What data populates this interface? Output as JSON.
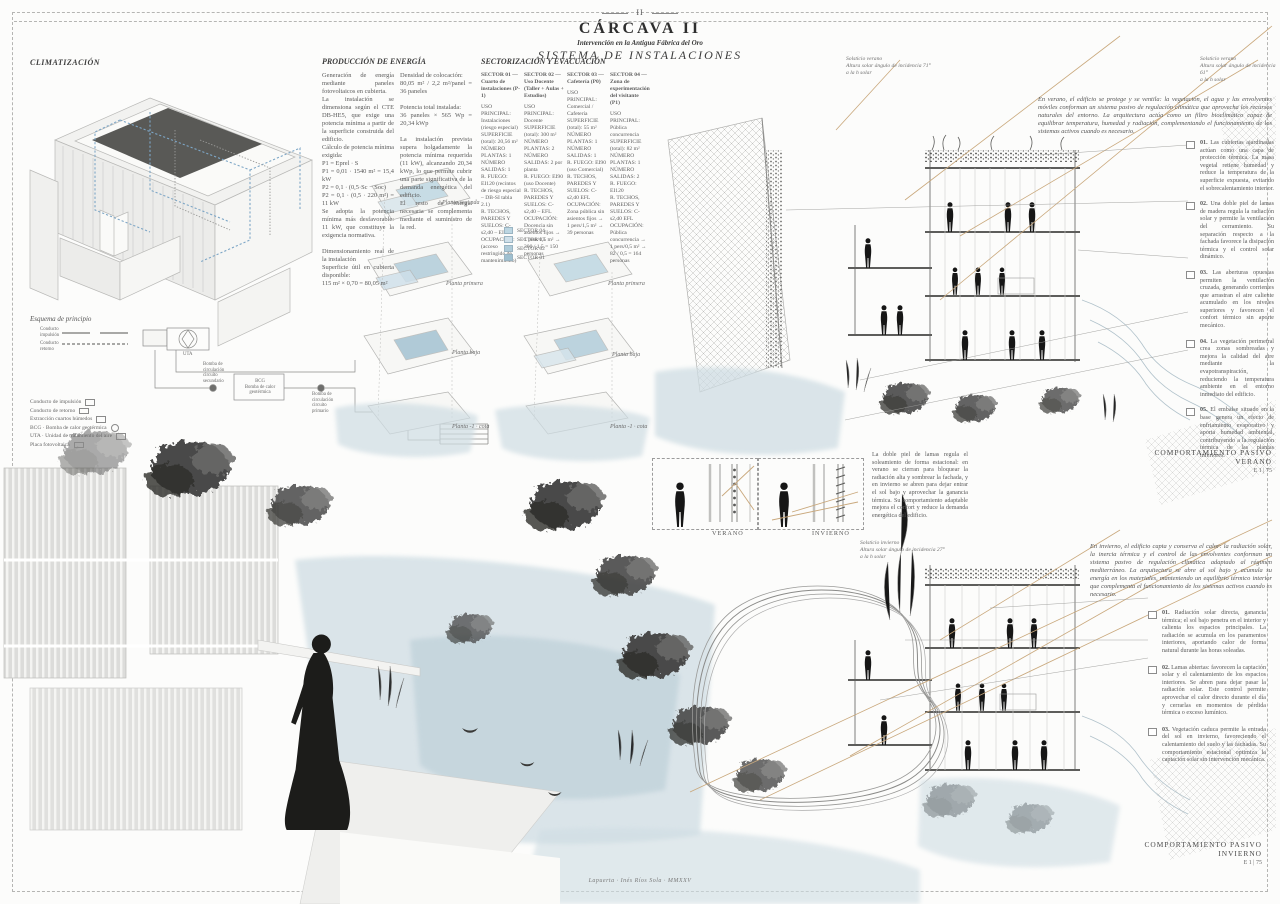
{
  "title_block": {
    "page_num": "II",
    "title": "CÁRCAVA II",
    "subtitle": "Intervención en la Antigua Fábrica del Oro",
    "section": "SISTEMA DE INSTALACIONES"
  },
  "colors": {
    "paper": "#fcfcfb",
    "ink": "#4c4c4c",
    "drawing_gray": "#c9c9c9",
    "duct_blue": "#7da6c6",
    "wash_blue": "#cfdde3",
    "sun_tan": "#c9a87c",
    "sector_fill": "#bcd6e2"
  },
  "climatizacion": {
    "heading": "CLIMATIZACIÓN",
    "esquema_label": "Esquema de principio",
    "schematic": {
      "uta": "UTA",
      "bcg": "BCG\nBomba de calor\ngeotérmica",
      "bomba_secundario": "Bomba de\ncirculación\ncircuito\nsecundario",
      "bomba_primario": "Bomba de\ncirculación\ncircuito\nprimario"
    },
    "legend": [
      {
        "label": "Conducto de impulsión",
        "symbol": "duct"
      },
      {
        "label": "Conducto de retorno",
        "symbol": "duct"
      },
      {
        "label": "Extracción cuartos húmedos",
        "symbol": "duct"
      },
      {
        "label": "BCG · Bomba de calor geotérmica",
        "symbol": "box"
      },
      {
        "label": "UTA · Unidad de tratamiento del aire",
        "symbol": "box"
      },
      {
        "label": "Placa fotovoltaica",
        "symbol": "panel"
      }
    ]
  },
  "produccion": {
    "heading": "PRODUCCIÓN DE ENERGÍA",
    "col1": "Generación de energía mediante paneles fotovoltaicos en cubierta.\nLa instalación se dimensiona según el CTE DB-HE5, que exige una potencia mínima a partir de la superficie construida del edificio.\nCálculo de potencia mínima exigida:\nP1 = Eprel · S\nP1 = 0,01 · 1540 m² = 15,4 kW\nP2 = 0,1 · (0,5·Sc − Soc)\nP2 = 0,1 · (0,5 · 220 m²) = 11 kW\nSe adopta la potencia mínima más desfavorable: 11 kW, que constituye la exigencia normativa.\n\nDimensionamiento real de la instalación\nSuperficie útil en cubierta disponible:\n115 m² × 0,70 = 80,05 m²",
    "col2": "Densidad de colocación:\n80,05 m² / 2,2 m²/panel = 36 paneles\n\nPotencia total instalada:\n36 paneles × 565 Wp = 20,34 kWp\n\nLa instalación prevista supera holgadamente la potencia mínima requerida (11 kW), alcanzando 20,34 kWp, lo que permite cubrir una parte significativa de la demanda energética del edificio.\nEl resto de energía necesaria se complementa mediante el suministro de la red."
  },
  "sectorizacion": {
    "heading": "SECTORIZACIÓN Y EVACUACIÓN",
    "sectors": [
      {
        "title": "SECTOR 01 — Cuarto de instalaciones (P-1)",
        "body": "USO PRINCIPAL: Instalaciones (riesgo especial)\nSUPERFICIE (total): 20,56 m²\nNÚMERO PLANTAS: 1\nNÚMERO SALIDAS: 1\nR. FUEGO: EI120 (recintos de riesgo especial – DB-SI tabla 2.1)\nR. TECHOS, PAREDES Y SUELOS: C-s2,d0 – EI120\nOCUPACIÓN: (acceso restringido de mantenimiento)"
      },
      {
        "title": "SECTOR 02 — Uso Docente (Taller + Aulas + Estudios)",
        "body": "USO PRINCIPAL: Docente\nSUPERFICIE (total): 300 m²\nNÚMERO PLANTAS: 2\nNÚMERO SALIDAS: 2 por planta\nR. FUEGO: EI90 (uso Docente)\nR. TECHOS, PAREDES Y SUELOS: C-s2,d0 – EFL\nOCUPACIÓN: Docencia sin asientos fijos → 1 pers/1,5 m² → 300 / 1,5 = 150 personas"
      },
      {
        "title": "SECTOR 03 — Cafetería (P0)",
        "body": "USO PRINCIPAL: Comercial / Cafetería\nSUPERFICIE (total): 55 m²\nNÚMERO PLANTAS: 1\nNÚMERO SALIDAS: 1\nR. FUEGO: EI90 (uso Comercial)\nR. TECHOS, PAREDES Y SUELOS: C-s2,d0 EFL\nOCUPACIÓN: Zona pública sin asientos fijos → 1 pers/1,5 m² → 39 personas"
      },
      {
        "title": "SECTOR 04 — Zona de experimentación del visitante (P1)",
        "body": "USO PRINCIPAL: Pública concurrencia\nSUPERFICIE (total): 82 m²\nNÚMERO PLANTAS: 1\nNÚMERO SALIDAS: 2\nR. FUEGO: EI120\nR. TECHOS, PAREDES Y SUELOS: C-s2,d0 EFL\nOCUPACIÓN: Pública concurrencia → 1 pers/0,5 m² → 82 / 0,5 = 164 personas"
      }
    ],
    "legend": [
      "SECTOR 04",
      "SECTOR 03",
      "SECTOR 02",
      "SECTOR 01"
    ],
    "plans_left": [
      "Planta segunda",
      "Planta primera",
      "Planta baja",
      "Planta -1 · cota"
    ],
    "plans_right": [
      "Planta primera",
      "Planta baja",
      "Planta -1 · cota"
    ]
  },
  "verano": {
    "sun_label_left": "Solsticio verano\nAltura solar ángulo de incidencia 71°\na la h solar",
    "sun_label_right": "Solsticio verano\nAltura solar ángulo de incidencia 61°\na la h solar",
    "intro": "En verano, el edificio se protege y se ventila: la vegetación, el agua y las envolventes móviles conforman un sistema pasivo de regulación climática que aprovecha los recursos naturales del entorno. La arquitectura actúa como un filtro bioclimático capaz de equilibrar temperatura, humedad y radiación, complementando el funcionamiento de los sistemas activos cuando es necesario.",
    "notes": [
      {
        "num": "01.",
        "text": "Las cubiertas ajardinadas actúan como una capa de protección térmica. La masa vegetal retiene humedad y reduce la temperatura de la superficie expuesta, evitando el sobrecalentamiento interior."
      },
      {
        "num": "02.",
        "text": "Una doble piel de lamas de madera regula la radiación solar y permite la ventilación del cerramiento. Su separación respecto a la fachada favorece la disipación térmica y el control solar dinámico."
      },
      {
        "num": "03.",
        "text": "Las aberturas opuestas permiten la ventilación cruzada, generando corrientes que arrastran el aire caliente acumulado en los niveles superiores y favorecen el confort térmico sin aporte mecánico."
      },
      {
        "num": "04.",
        "text": "La vegetación perimetral crea zonas sombreadas y mejora la calidad del aire mediante la evapotranspiración, reduciendo la temperatura ambiente en el entorno inmediato del edificio."
      },
      {
        "num": "05.",
        "text": "El embalse situado en la base genera un efecto de enfriamiento evaporativo y aporta humedad ambiental, contribuyendo a la regulación térmica de las plantas inferiores."
      }
    ],
    "scale_label": "COMPORTAMIENTO PASIVO\nVERANO",
    "scale": "E 1 | 75"
  },
  "louvers": {
    "verano_label": "VERANO",
    "invierno_label": "INVIERNO",
    "paragraph": "La doble piel de lamas regula el soleamiento de forma estacional: en verano se cierran para bloquear la radiación alta y sombrear la fachada, y en invierno se abren para dejar entrar el sol bajo y aprovechar la ganancia térmica. Su comportamiento adaptable mejora el confort y reduce la demanda energética del edificio."
  },
  "invierno": {
    "sun_label": "Solsticio invierno\nAltura solar ángulo de incidencia 27°\na la h solar",
    "intro": "En invierno, el edificio capta y conserva el calor: la radiación solar, la inercia térmica y el control de las envolventes conforman un sistema pasivo de regulación climática adaptado al régimen mediterráneo. La arquitectura se abre al sol bajo y acumula su energía en los materiales, manteniendo un equilibrio térmico interior que complementa el funcionamiento de los sistemas activos cuando es necesario.",
    "notes": [
      {
        "num": "01.",
        "text": "Radiación solar directa, ganancia térmica; el sol bajo penetra en el interior y calienta los espacios principales. La radiación se acumula en los paramentos interiores, aportando calor de forma natural durante las horas soleadas."
      },
      {
        "num": "02.",
        "text": "Lamas abiertas: favorecen la captación solar y el calentamiento de los espacios interiores. Se abren para dejar pasar la radiación solar. Este control permite aprovechar el calor directo durante el día y cerrarlas en momentos de pérdida térmica o exceso lumínico."
      },
      {
        "num": "03.",
        "text": "Vegetación caduca permite la entrada del sol en invierno, favoreciendo el calentamiento del suelo y las fachadas. Su comportamiento estacional optimiza la captación solar sin intervención mecánica."
      }
    ],
    "scale_label": "COMPORTAMIENTO PASIVO\nINVIERNO",
    "scale": "E 1 | 75"
  },
  "credit": "Lapuerta · Inés Ríos Sola · MMXXV"
}
